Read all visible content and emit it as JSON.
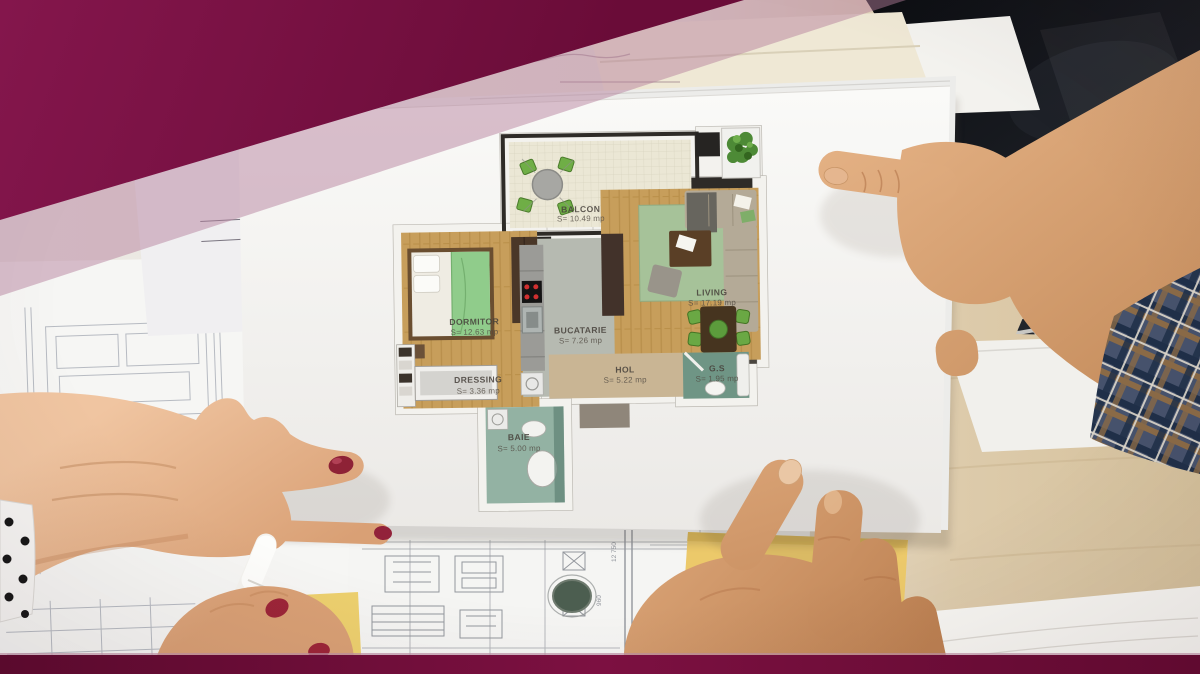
{
  "floor_plan": {
    "rooms": [
      {
        "id": "balcon",
        "name": "BALCON",
        "area": "S= 10.49 mp"
      },
      {
        "id": "living",
        "name": "LIVING",
        "area": "S= 17.19 mp"
      },
      {
        "id": "dormitor",
        "name": "DORMITOR",
        "area": "S= 12.63 mp"
      },
      {
        "id": "bucatarie",
        "name": "BUCATARIE",
        "area": "S= 7.26 mp"
      },
      {
        "id": "dressing",
        "name": "DRESSING",
        "area": "S= 3.36 mp"
      },
      {
        "id": "hol",
        "name": "HOL",
        "area": "S= 5.22 mp"
      },
      {
        "id": "gs",
        "name": "G.S",
        "area": "S= 1.95 mp"
      },
      {
        "id": "baie",
        "name": "BAIE",
        "area": "S= 5.00 mp"
      }
    ]
  },
  "background": {
    "blueprint_dimensions": [
      "12 750",
      "960"
    ]
  },
  "colors": {
    "brand_maroon": "#7a1143",
    "brand_maroon_dark": "#5f0a30",
    "overlay_mauve": "#b47e9b",
    "sticky_note_yellow": "#ecc96a",
    "nail_polish_red": "#8e2236",
    "plan_wood_floor": "#c79e5b",
    "plan_rug_green": "#a6c299",
    "plan_chair_green": "#6aa844",
    "plan_bath_teal": "#93b2a3",
    "laptop_screen_black": "#101216",
    "desk_wood": "#dcc9a8"
  }
}
